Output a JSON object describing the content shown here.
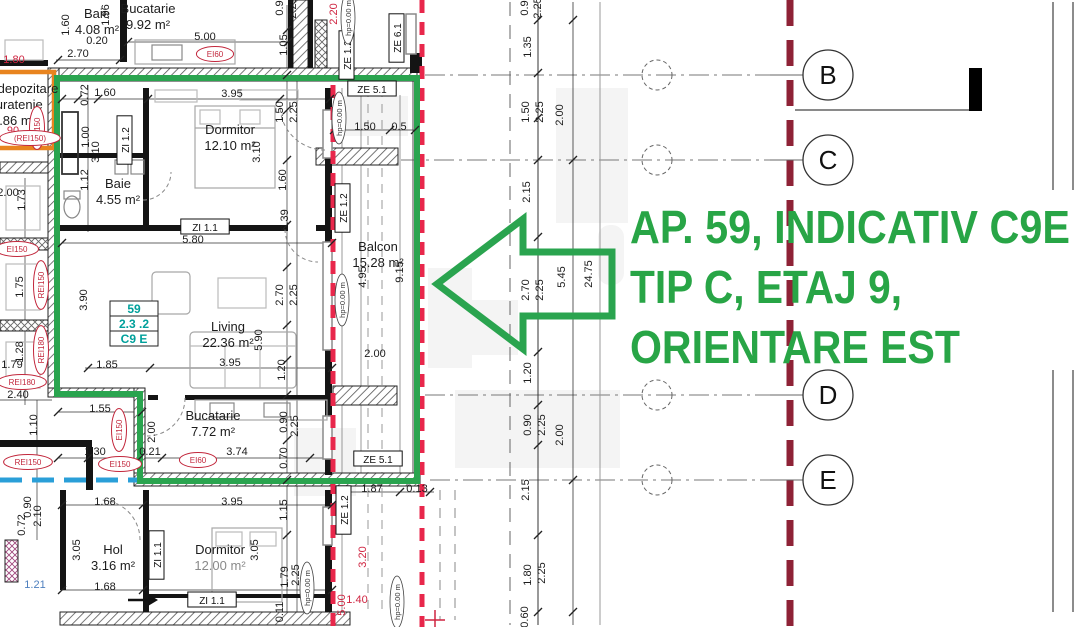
{
  "annotation": {
    "line1": "AP. 59, INDICATIV C9E",
    "line2": "TIP C, ETAJ 9,",
    "line3": "ORIENTARE EST",
    "color": "#28a546"
  },
  "badge": {
    "lines": [
      "59",
      "2.3 .2",
      "C9 E"
    ],
    "color": "#00a09b"
  },
  "grid": {
    "axes": [
      {
        "label": "B",
        "y": 75
      },
      {
        "label": "C",
        "y": 160
      },
      {
        "label": "D",
        "y": 395
      },
      {
        "label": "E",
        "y": 480
      }
    ]
  },
  "colors": {
    "green": "#2aa44f",
    "red": "#e8274b",
    "maroon": "#8e2236",
    "blue": "#2a9fd8",
    "orange": "#e8841f",
    "teal": "#00a09b"
  },
  "hp_text": "hp=0.00 m",
  "rooms": [
    {
      "x": 97,
      "y": 18,
      "name": "Baie",
      "area": "4.08 m²"
    },
    {
      "x": 148,
      "y": 13,
      "name": "Bucatarie",
      "area": "9.92 m²"
    },
    {
      "x": 28,
      "y": 93,
      "name": "depozitare",
      "area": ""
    },
    {
      "x": 16,
      "y": 109,
      "name": "curatenie",
      "area": ""
    },
    {
      "x": 14,
      "y": 125,
      "name": "1.86 m²",
      "area": ""
    },
    {
      "x": 230,
      "y": 134,
      "name": "Dormitor",
      "area": "12.10 m²"
    },
    {
      "x": 118,
      "y": 188,
      "name": "Baie",
      "area": "4.55 m²"
    },
    {
      "x": 228,
      "y": 331,
      "name": "Living",
      "area": "22.36 m²"
    },
    {
      "x": 378,
      "y": 251,
      "name": "Balcon",
      "area": "15.28 m²"
    },
    {
      "x": 213,
      "y": 420,
      "name": "Bucatarie",
      "area": "7.72 m²"
    },
    {
      "x": 113,
      "y": 554,
      "name": "Hol",
      "area": "3.16 m²"
    },
    {
      "x": 220,
      "y": 554,
      "name": "Dormitor",
      "area": "12.00 m²",
      "light": true
    }
  ],
  "dims": [
    {
      "x": 78,
      "y": 57,
      "t": "2.70"
    },
    {
      "x": 69,
      "y": 25,
      "t": "1.60",
      "r": 1
    },
    {
      "x": 109,
      "y": 15,
      "t": "1.96",
      "r": 1
    },
    {
      "x": 205,
      "y": 40,
      "t": "5.00"
    },
    {
      "x": 97,
      "y": 44,
      "t": "0.20"
    },
    {
      "x": 287,
      "y": 45,
      "t": "1.05",
      "r": 1
    },
    {
      "x": 283,
      "y": 8,
      "t": "0.9",
      "r": 1
    },
    {
      "x": 296,
      "y": 8,
      "t": "2.25",
      "r": 1
    },
    {
      "x": 337,
      "y": 14,
      "t": "2.20",
      "r": 1,
      "c": "red"
    },
    {
      "x": 14,
      "y": 63,
      "t": "1.80",
      "c": "red"
    },
    {
      "x": 13,
      "y": 134,
      "t": "90",
      "c": "red"
    },
    {
      "x": 105,
      "y": 96,
      "t": "1.60"
    },
    {
      "x": 88,
      "y": 95,
      "t": "0.72",
      "r": 1
    },
    {
      "x": 232,
      "y": 97,
      "t": "3.95"
    },
    {
      "x": 283,
      "y": 112,
      "t": "1.50",
      "r": 1
    },
    {
      "x": 297,
      "y": 112,
      "t": "2.25",
      "r": 1
    },
    {
      "x": 365,
      "y": 130,
      "t": "1.50"
    },
    {
      "x": 399,
      "y": 130,
      "t": "0.5"
    },
    {
      "x": 89,
      "y": 137,
      "t": "1.00",
      "r": 1
    },
    {
      "x": 99,
      "y": 152,
      "t": "3.10",
      "r": 1
    },
    {
      "x": 260,
      "y": 152,
      "t": "3.10",
      "r": 1
    },
    {
      "x": 88,
      "y": 180,
      "t": "1.12",
      "r": 1
    },
    {
      "x": 286,
      "y": 180,
      "t": "1.60",
      "r": 1
    },
    {
      "x": 288,
      "y": 220,
      "t": "0.39",
      "r": 1
    },
    {
      "x": 193,
      "y": 243,
      "t": "5.80"
    },
    {
      "x": 25,
      "y": 200,
      "t": "1.73",
      "r": 1
    },
    {
      "x": 8,
      "y": 196,
      "t": "2.00"
    },
    {
      "x": 23,
      "y": 287,
      "t": "1.75",
      "r": 1
    },
    {
      "x": 87,
      "y": 300,
      "t": "3.90",
      "r": 1
    },
    {
      "x": 283,
      "y": 295,
      "t": "2.70",
      "r": 1
    },
    {
      "x": 297,
      "y": 295,
      "t": "2.25",
      "r": 1
    },
    {
      "x": 262,
      "y": 340,
      "t": "5.90",
      "r": 1
    },
    {
      "x": 230,
      "y": 366,
      "t": "3.95"
    },
    {
      "x": 107,
      "y": 368,
      "t": "1.85"
    },
    {
      "x": 285,
      "y": 370,
      "t": "1.20",
      "r": 1
    },
    {
      "x": 375,
      "y": 357,
      "t": "2.00"
    },
    {
      "x": 366,
      "y": 277,
      "t": "4.95",
      "r": 1
    },
    {
      "x": 403,
      "y": 272,
      "t": "9.15",
      "r": 1
    },
    {
      "x": 23,
      "y": 352,
      "t": "1.28",
      "r": 1
    },
    {
      "x": 12,
      "y": 368,
      "t": "1.79"
    },
    {
      "x": 18,
      "y": 398,
      "t": "2.40"
    },
    {
      "x": 100,
      "y": 412,
      "t": "1.55"
    },
    {
      "x": 37,
      "y": 425,
      "t": "1.10",
      "r": 1
    },
    {
      "x": 155,
      "y": 432,
      "t": "2.00",
      "r": 1
    },
    {
      "x": 287,
      "y": 422,
      "t": "0.90",
      "r": 1
    },
    {
      "x": 298,
      "y": 426,
      "t": "2.25",
      "r": 1
    },
    {
      "x": 287,
      "y": 458,
      "t": "0.70",
      "r": 1
    },
    {
      "x": 95,
      "y": 455,
      "t": "1.30"
    },
    {
      "x": 150,
      "y": 455,
      "t": "0.21"
    },
    {
      "x": 237,
      "y": 455,
      "t": "3.74"
    },
    {
      "x": 105,
      "y": 505,
      "t": "1.68"
    },
    {
      "x": 232,
      "y": 505,
      "t": "3.95"
    },
    {
      "x": 287,
      "y": 510,
      "t": "1.15",
      "r": 1
    },
    {
      "x": 25,
      "y": 525,
      "t": "0.72",
      "r": 1
    },
    {
      "x": 31,
      "y": 507,
      "t": "0.90",
      "r": 1
    },
    {
      "x": 41,
      "y": 516,
      "t": "2.10",
      "r": 1
    },
    {
      "x": 80,
      "y": 550,
      "t": "3.05",
      "r": 1
    },
    {
      "x": 258,
      "y": 550,
      "t": "3.05",
      "r": 1
    },
    {
      "x": 35,
      "y": 588,
      "t": "1.21",
      "c": "blue"
    },
    {
      "x": 105,
      "y": 590,
      "t": "1.68"
    },
    {
      "x": 288,
      "y": 577,
      "t": "1.79",
      "r": 1
    },
    {
      "x": 299,
      "y": 575,
      "t": "2.25",
      "r": 1
    },
    {
      "x": 283,
      "y": 612,
      "t": "0.11",
      "r": 1
    },
    {
      "x": 372,
      "y": 492,
      "t": "1.87"
    },
    {
      "x": 417,
      "y": 492,
      "t": "0.13"
    },
    {
      "x": 366,
      "y": 557,
      "t": "3.20",
      "r": 1,
      "c": "red"
    },
    {
      "x": 345,
      "y": 605,
      "t": "5.00",
      "r": 1,
      "c": "red"
    },
    {
      "x": 357,
      "y": 603,
      "t": "1.40",
      "c": "red"
    },
    {
      "x": 528,
      "y": 8,
      "t": "0.9",
      "r": 1
    },
    {
      "x": 541,
      "y": 8,
      "t": "2.25",
      "r": 1
    },
    {
      "x": 531,
      "y": 47,
      "t": "1.35",
      "r": 1
    },
    {
      "x": 529,
      "y": 112,
      "t": "1.50",
      "r": 1
    },
    {
      "x": 543,
      "y": 112,
      "t": "2.25",
      "r": 1
    },
    {
      "x": 563,
      "y": 115,
      "t": "2.00",
      "r": 1
    },
    {
      "x": 530,
      "y": 192,
      "t": "2.15",
      "r": 1
    },
    {
      "x": 529,
      "y": 290,
      "t": "2.70",
      "r": 1
    },
    {
      "x": 543,
      "y": 290,
      "t": "2.25",
      "r": 1
    },
    {
      "x": 565,
      "y": 277,
      "t": "5.45",
      "r": 1
    },
    {
      "x": 592,
      "y": 274,
      "t": "24.75",
      "r": 1
    },
    {
      "x": 531,
      "y": 373,
      "t": "1.20",
      "r": 1
    },
    {
      "x": 531,
      "y": 425,
      "t": "0.90",
      "r": 1
    },
    {
      "x": 545,
      "y": 425,
      "t": "2.25",
      "r": 1
    },
    {
      "x": 563,
      "y": 435,
      "t": "2.00",
      "r": 1
    },
    {
      "x": 529,
      "y": 490,
      "t": "2.15",
      "r": 1
    },
    {
      "x": 531,
      "y": 575,
      "t": "1.80",
      "r": 1
    },
    {
      "x": 545,
      "y": 573,
      "t": "2.25",
      "r": 1
    },
    {
      "x": 528,
      "y": 617,
      "t": "0.60",
      "r": 1
    }
  ],
  "tags": [
    {
      "x": 350,
      "y": 55,
      "t": "ZE 1.2",
      "r": 1
    },
    {
      "x": 400,
      "y": 38,
      "t": "ZE 6.1",
      "r": 1
    },
    {
      "x": 372,
      "y": 92,
      "t": "ZE 5.1"
    },
    {
      "x": 128,
      "y": 140,
      "t": "ZI 1.2",
      "r": 1
    },
    {
      "x": 205,
      "y": 230,
      "t": "ZI 1.1"
    },
    {
      "x": 346,
      "y": 208,
      "t": "ZE 1.2",
      "r": 1
    },
    {
      "x": 378,
      "y": 462,
      "t": "ZE 5.1"
    },
    {
      "x": 347,
      "y": 510,
      "t": "ZE 1.2",
      "r": 1
    },
    {
      "x": 160,
      "y": 555,
      "t": "ZI 1.1",
      "r": 1
    },
    {
      "x": 212,
      "y": 603,
      "t": "ZI 1.1"
    }
  ],
  "fire_labels": [
    {
      "x": 215,
      "y": 57,
      "t": "EI60"
    },
    {
      "x": 40,
      "y": 128,
      "t": "EI150",
      "r": 1
    },
    {
      "x": 30,
      "y": 141,
      "t": "(REI150)"
    },
    {
      "x": 17,
      "y": 252,
      "t": "EI150"
    },
    {
      "x": 44,
      "y": 285,
      "t": "REI150",
      "r": 1
    },
    {
      "x": 44,
      "y": 350,
      "t": "REI180",
      "r": 1
    },
    {
      "x": 22,
      "y": 385,
      "t": "REI180"
    },
    {
      "x": 122,
      "y": 430,
      "t": "EI150",
      "r": 1
    },
    {
      "x": 28,
      "y": 465,
      "t": "REI150"
    },
    {
      "x": 120,
      "y": 467,
      "t": "EI150"
    },
    {
      "x": 198,
      "y": 463,
      "t": "EI60"
    }
  ],
  "hp_labels": [
    {
      "x": 351,
      "y": 18,
      "r": 1
    },
    {
      "x": 342,
      "y": 118,
      "r": 1
    },
    {
      "x": 345,
      "y": 300,
      "r": 1
    },
    {
      "x": 310,
      "y": 588,
      "r": 1
    },
    {
      "x": 400,
      "y": 602,
      "r": 1
    }
  ]
}
